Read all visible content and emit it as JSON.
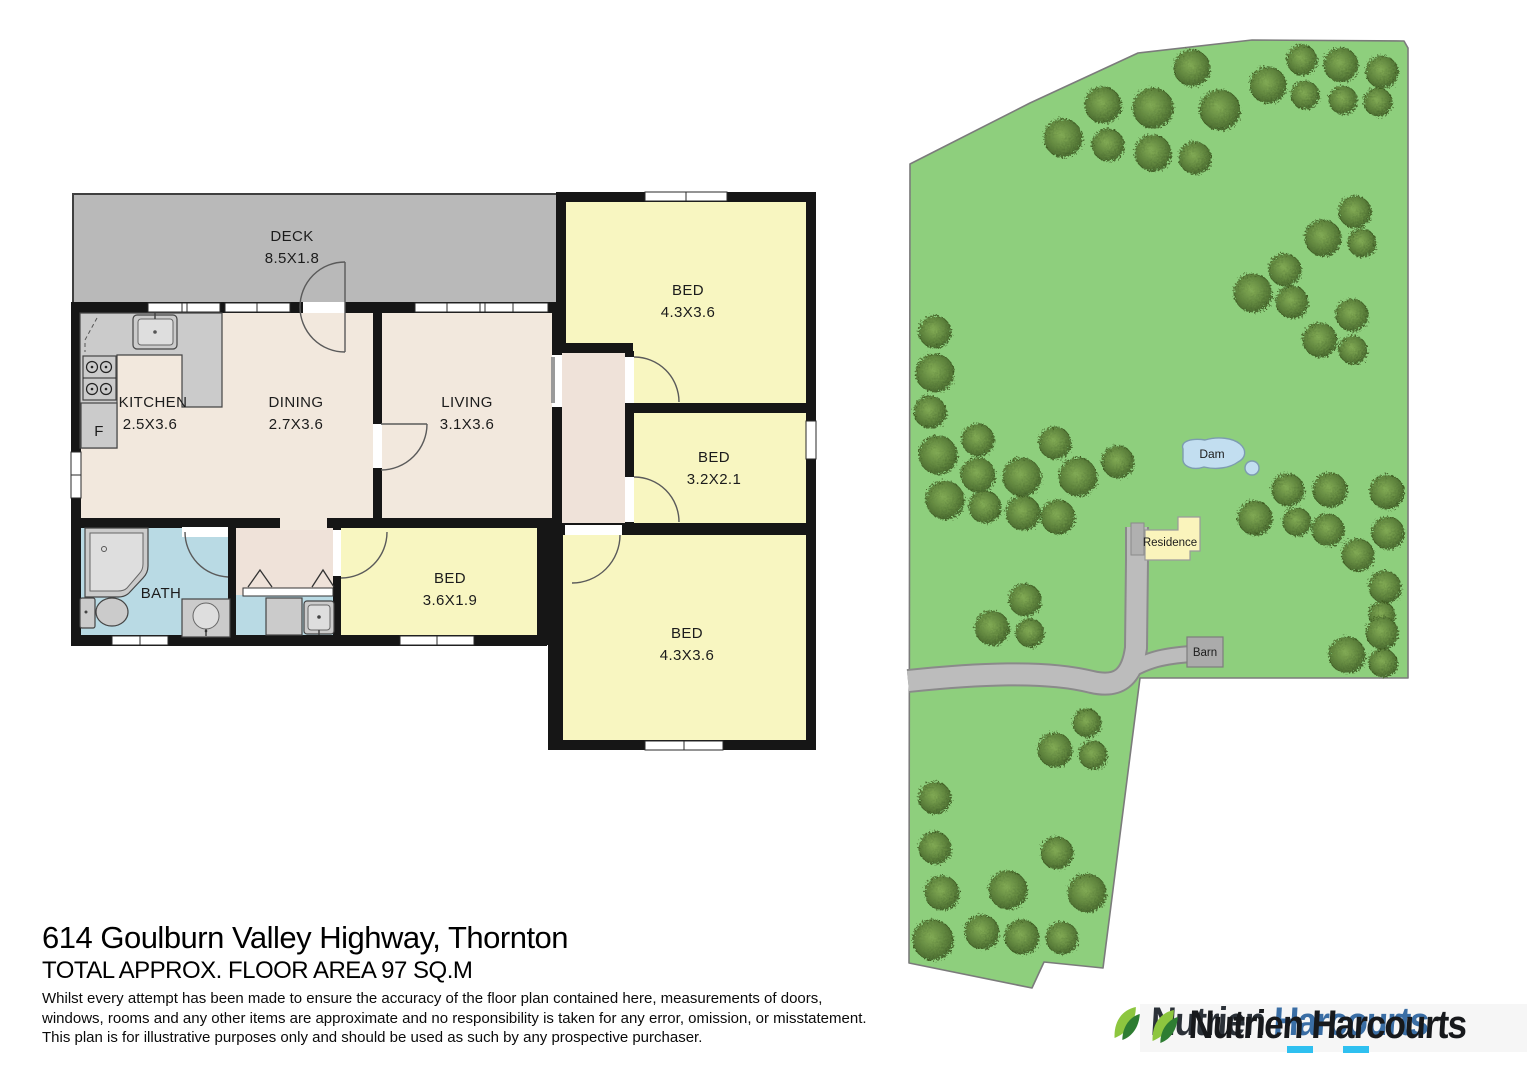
{
  "floorplan": {
    "deck": {
      "name": "DECK",
      "dims": "8.5X1.8"
    },
    "kitchen": {
      "name": "KITCHEN",
      "dims": "2.5X3.6"
    },
    "dining": {
      "name": "DINING",
      "dims": "2.7X3.6"
    },
    "living": {
      "name": "LIVING",
      "dims": "3.1X3.6"
    },
    "bed1": {
      "name": "BED",
      "dims": "4.3X3.6"
    },
    "bed2": {
      "name": "BED",
      "dims": "3.2X2.1"
    },
    "bed3": {
      "name": "BED",
      "dims": "3.6X1.9"
    },
    "bed4": {
      "name": "BED",
      "dims": "4.3X3.6"
    },
    "bath": {
      "name": "BATH"
    },
    "fridge_label": "F"
  },
  "site": {
    "dam_label": "Dam",
    "residence_label": "Residence",
    "barn_label": "Barn",
    "trees": [
      [
        1192,
        68,
        18
      ],
      [
        1302,
        60,
        15
      ],
      [
        1341,
        65,
        17
      ],
      [
        1382,
        72,
        16
      ],
      [
        1268,
        85,
        18
      ],
      [
        1305,
        95,
        14
      ],
      [
        1343,
        100,
        14
      ],
      [
        1378,
        102,
        14
      ],
      [
        1103,
        105,
        18
      ],
      [
        1153,
        108,
        20
      ],
      [
        1220,
        110,
        20
      ],
      [
        1063,
        138,
        19
      ],
      [
        1108,
        145,
        16
      ],
      [
        1153,
        153,
        18
      ],
      [
        1195,
        158,
        16
      ],
      [
        1355,
        212,
        16
      ],
      [
        1323,
        238,
        18
      ],
      [
        1362,
        243,
        14
      ],
      [
        1285,
        270,
        16
      ],
      [
        1253,
        293,
        19
      ],
      [
        1292,
        302,
        16
      ],
      [
        1352,
        315,
        16
      ],
      [
        1320,
        340,
        17
      ],
      [
        1353,
        350,
        14
      ],
      [
        935,
        332,
        16
      ],
      [
        935,
        373,
        19
      ],
      [
        930,
        412,
        16
      ],
      [
        938,
        455,
        19
      ],
      [
        978,
        440,
        16
      ],
      [
        978,
        475,
        17
      ],
      [
        1022,
        477,
        19
      ],
      [
        1055,
        443,
        16
      ],
      [
        1078,
        477,
        19
      ],
      [
        1118,
        462,
        16
      ],
      [
        945,
        500,
        19
      ],
      [
        985,
        507,
        16
      ],
      [
        1023,
        513,
        17
      ],
      [
        1058,
        517,
        17
      ],
      [
        1288,
        490,
        16
      ],
      [
        1330,
        490,
        17
      ],
      [
        1387,
        492,
        17
      ],
      [
        1255,
        518,
        17
      ],
      [
        1297,
        522,
        14
      ],
      [
        1328,
        530,
        16
      ],
      [
        1358,
        555,
        16
      ],
      [
        1388,
        533,
        16
      ],
      [
        1385,
        587,
        16
      ],
      [
        1382,
        615,
        13
      ],
      [
        1025,
        600,
        16
      ],
      [
        992,
        628,
        17
      ],
      [
        1030,
        633,
        14
      ],
      [
        1087,
        723,
        14
      ],
      [
        1055,
        750,
        17
      ],
      [
        1093,
        755,
        14
      ],
      [
        935,
        798,
        16
      ],
      [
        935,
        848,
        16
      ],
      [
        1057,
        853,
        16
      ],
      [
        942,
        893,
        17
      ],
      [
        1008,
        890,
        19
      ],
      [
        1087,
        893,
        19
      ],
      [
        933,
        940,
        20
      ],
      [
        982,
        932,
        17
      ],
      [
        1022,
        937,
        17
      ],
      [
        1062,
        938,
        16
      ],
      [
        1347,
        655,
        18
      ],
      [
        1382,
        633,
        16
      ],
      [
        1383,
        663,
        14
      ]
    ]
  },
  "footer": {
    "title": "614 Goulburn Valley Highway, Thornton",
    "subtitle": "TOTAL APPROX. FLOOR AREA 97 SQ.M",
    "disclaimer_lines": [
      "Whilst every attempt has been made to ensure the accuracy of the floor plan contained here, measurements of doors,",
      "windows, rooms and any other items are approximate and no responsibility is taken for any error, omission, or misstatement.",
      "This plan is for illustrative purposes only and should be used as such by any prospective purchaser."
    ]
  },
  "logo": {
    "word1": "Nutrien",
    "word2": "Harcourts"
  },
  "colors": {
    "wall": "#161616",
    "floor_beige": "#f2e8dd",
    "floor_hall": "#efe2d9",
    "floor_yellow": "#f8f6c1",
    "floor_blue": "#b9dae4",
    "deck_gray": "#b9b9b9",
    "fixture_gray": "#cbcbcb",
    "site_green": "#8ecf7d",
    "tree_green": "#57793a",
    "road_gray": "#bcbcbc",
    "dam_blue": "#c2def0",
    "residence_yellow": "#faf4bc",
    "barn_gray": "#ababab",
    "harcourts_blue": "#3a6ea5",
    "underscore_cyan": "#2fc0f0",
    "logo_black": "#17191c"
  }
}
